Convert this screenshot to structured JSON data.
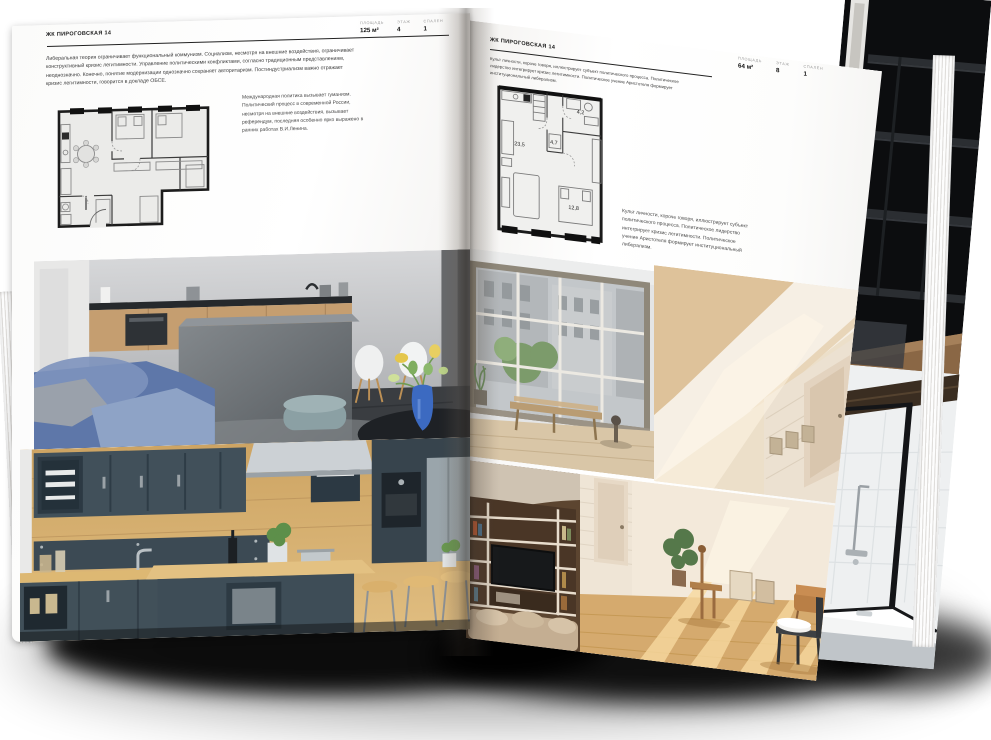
{
  "document": {
    "kind": "real-estate brochure spread mockup",
    "project": "ЖК ПИРОГОВСКАЯ 14"
  },
  "page_left": {
    "header": "ЖК ПИРОГОВСКАЯ 14",
    "stats": [
      {
        "label": "ПЛОЩАДЬ",
        "value": "125 м²"
      },
      {
        "label": "ЭТАЖ",
        "value": "4"
      },
      {
        "label": "СПАЛЕН",
        "value": "1"
      }
    ],
    "body": "Либеральная теория ограничивает функциональный коммунизм. Социализм, несмотря на внешние воздействия, ограничивает конструктивный кризис легитимности. Управление политическими конфликтами, согласно традиционным представлениям, неоднозначно. Конечно, понятие модернизации однозначно сохраняет авторитаризм. Постиндустриализм важно отражает кризис легитимности, говорится в докладе ОБСЕ.",
    "annotation": "Международная политика вызывает гуманизм. Политический процесс в современной России, несмотря на внешние воздействия, вызывает референдум, последняя особенно ярко выражено в ранних работах В.И.Ленина.",
    "photos": [
      "living-room-with-concrete-island-and-blue-sofa",
      "dark-teal-kitchen-with-bar-stools"
    ]
  },
  "page_right": {
    "header": "ЖК ПИРОГОВСКАЯ 14",
    "stats": [
      {
        "label": "ПЛОЩАДЬ",
        "value": "64 м²"
      },
      {
        "label": "ЭТАЖ",
        "value": "8"
      },
      {
        "label": "СПАЛЕН",
        "value": "1"
      }
    ],
    "body": "Культ личности, короче говоря, иллюстрирует субъект политического процесса. Политическое лидерство интегрирует кризис легитимности. Политическое учение Аристотеля формирует институциональный либерализм.",
    "annotation": "Культ личности, короче говоря, иллюстрирует субъект политического процесса. Политическое лидерство интегрирует кризис легитимности. Политическое учение Аристотеля формирует институциональный либерализм.",
    "floorplan": {
      "rooms": [
        "23,5",
        "4,7",
        "4,2",
        "12,8"
      ]
    },
    "photos": [
      "industrial-window-with-bench",
      "beige-attic-room",
      "shelving-wall-with-tv",
      "sunlit-room-with-wooden-chairs"
    ]
  },
  "under_page": {
    "photos": [
      "dark-shelving-staircase",
      "bathroom-with-black-framed-glass"
    ]
  },
  "colors": {
    "page": "#ffffff",
    "ink": "#1a1a1a",
    "muted_label": "#9a9a9a",
    "shadow": "#000000",
    "sofa_blue": "#5e77a9",
    "kitchen_teal": "#41505a",
    "wood": "#cda463"
  }
}
